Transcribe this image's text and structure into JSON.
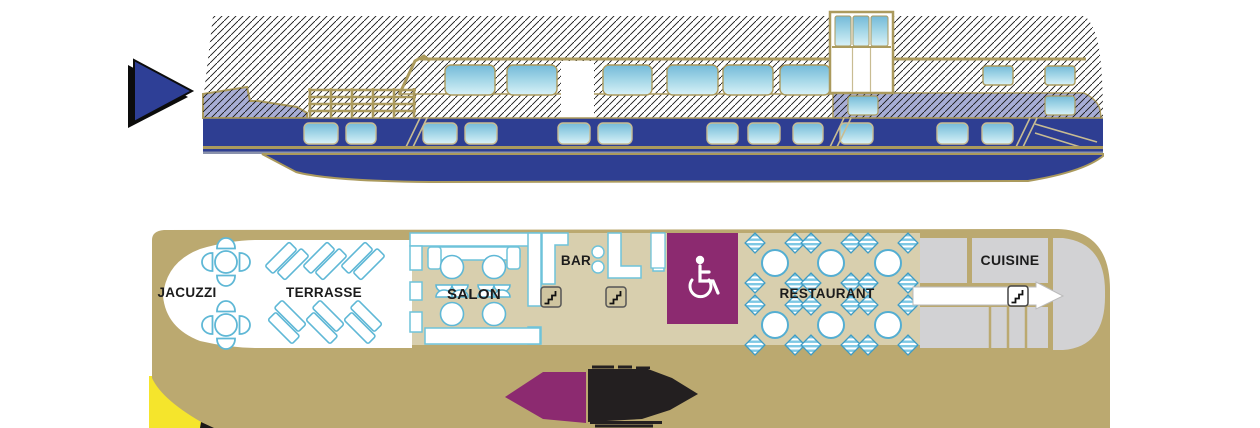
{
  "deck_plan": {
    "jacuzzi": {
      "label": "JACUZZI",
      "tub_count": 2
    },
    "terrasse": {
      "label": "TERRASSE",
      "lounger_pairs": 6
    },
    "salon": {
      "label": "SALON",
      "tables": 4
    },
    "bar": {
      "label": "BAR",
      "stools": 2
    },
    "accessible_cabin": {
      "icon": "wheelchair"
    },
    "restaurant": {
      "label": "RESTAURANT",
      "tables": 6,
      "chairs_per_table": 4
    },
    "cuisine": {
      "label": "CUISINE"
    },
    "stairs_icons": 3
  },
  "icons": {
    "nav_arrow": "right-pointing-triangle",
    "stairs": "staircase-steps",
    "wheelchair": "wheelchair-symbol"
  },
  "colors": {
    "hull_blue": "#2e3e92",
    "window_blue_top": "#7fc0d8",
    "window_blue_bottom": "#d6f0f6",
    "ship_outline_tan": "#ab9a5d",
    "deck_tan": "#bba970",
    "interior_beige": "#d8cfae",
    "furniture_outline_blue": "#6fc3da",
    "accessible_purple": "#8c2a70",
    "galley_gray": "#d2d2d4",
    "lavender_band": "#a8aed6",
    "highlight_yellow": "#f5e52c",
    "logo_black": "#231f20"
  }
}
